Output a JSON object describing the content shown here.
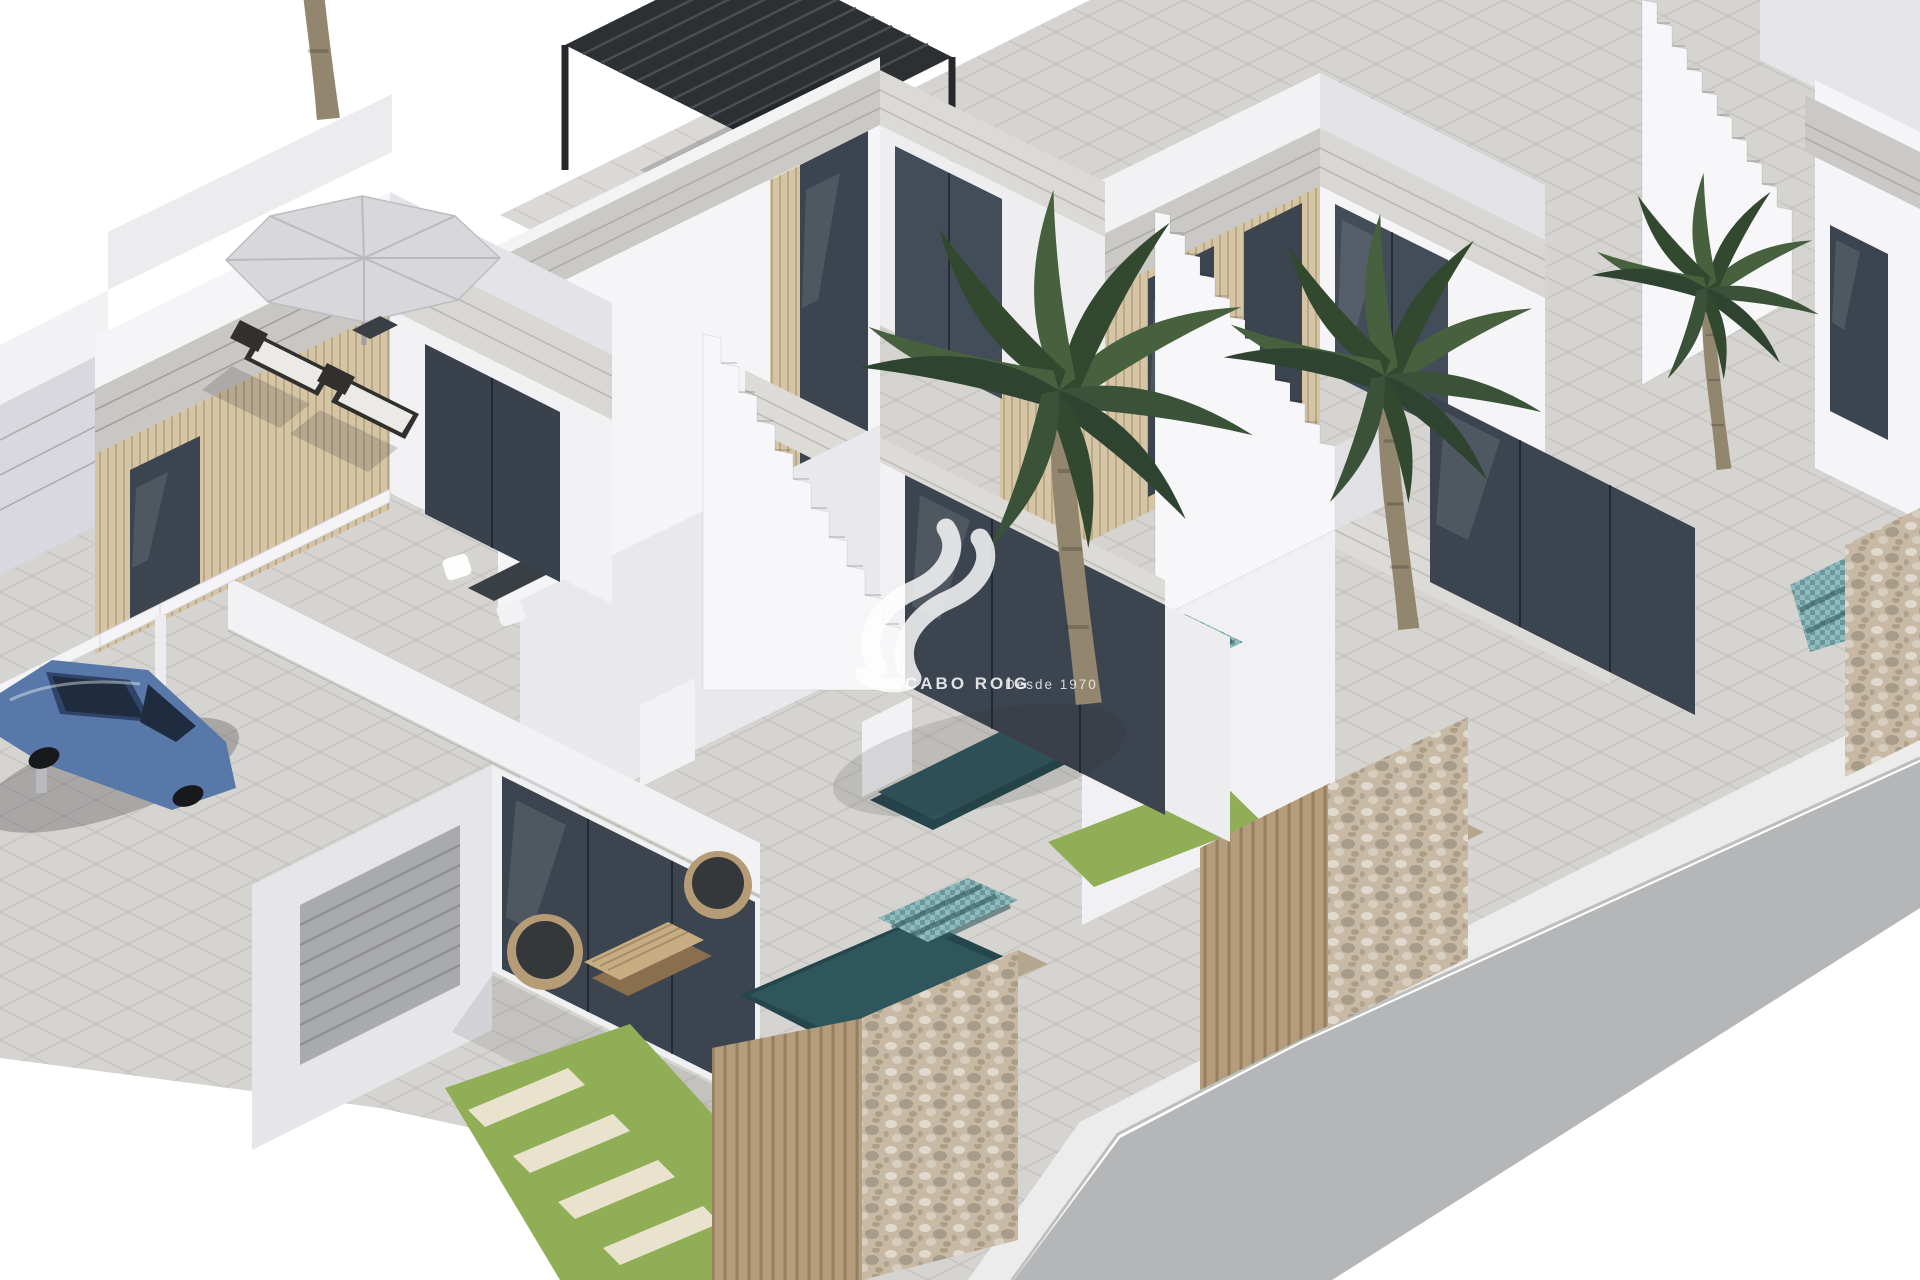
{
  "image": {
    "kind": "3d-architectural-render",
    "subject": "Row of modern white two-storey villas with roof terraces, external staircases, plunge pools, palm trees, stone boundary walls and a parked blue car beside a street",
    "width": 1920,
    "height": 1280
  },
  "watermark": {
    "brand": "CABO ROIG",
    "tagline": "Desde 1970",
    "color": "#ffffff"
  },
  "colors": {
    "background": "#ffffff",
    "terrain": "#d6d4d0",
    "road": "#b4b6b8",
    "sidewalk": "#ececec",
    "grass": "#8fae56",
    "stepping_stone": "#e9e3cd",
    "pool_water": "#2e565c",
    "pool_steps": "#7fb2b6",
    "rubble_wall": "#c7b9a4",
    "wood_fence": "#b49c7c",
    "wood_cladding": "#d5c5a4",
    "glass": "#3c4450",
    "wall_bright": "#f5f5f7",
    "wall_mid": "#e6e6ea",
    "wall_shadow": "#d8d8de",
    "stone_band": "#cbc9c5",
    "roof_tile": "#dbd9d5",
    "pergola": "#2d3033",
    "umbrella": "#d8d8da",
    "car_blue": "#5878aa",
    "palm_green": "#47613f",
    "palm_trunk": "#93866f",
    "garage_door": "#a8aaac"
  },
  "scene": {
    "elements": [
      "left villa with rooftop parasol and two sun loungers",
      "middle villa with black slatted rooftop pergola",
      "right villa with external white staircase",
      "far-right villa fragment with staircase",
      "blue sedan parked under white pergola beams",
      "three plunge pools with teal mosaic steps",
      "rubble stone boundary walls",
      "wooden slat fences and gates",
      "grass strips with stepping stones",
      "four palm trees",
      "street with white sidewalk curb"
    ],
    "villa_count": 4,
    "palm_count": 4,
    "pool_count": 3,
    "car_count": 1
  }
}
